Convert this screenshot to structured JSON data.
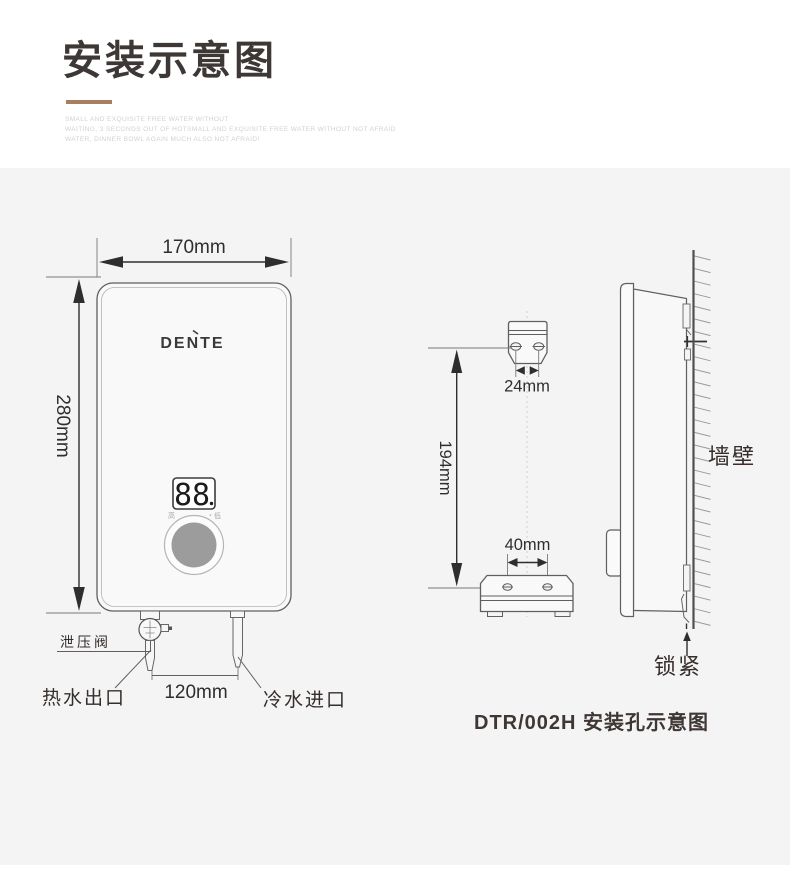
{
  "header": {
    "title": "安装示意图",
    "accent_color": "#a87e60",
    "subtitle_lines": [
      "SMALL AND EXQUISITE FREE WATER WITHOUT",
      "WAITING, 3 SECONDS OUT OF HOTSMALL AND EXQUISITE FREE WATER WITHOUT NOT AFRAID",
      "WATER, DINNER BOWL AGAIN MUCH ALSO NOT AFRAID!"
    ]
  },
  "front_view": {
    "brand": "DENTE",
    "display_value": "88",
    "knob_label_high": "高",
    "knob_label_low": "低",
    "dims": {
      "width": "170mm",
      "height": "280mm",
      "pipe_spacing": "120mm"
    },
    "labels": {
      "relief_valve": "泄压阀",
      "hot_water_outlet": "热水出口",
      "cold_water_inlet": "冷水进口"
    }
  },
  "side_view": {
    "dims": {
      "top_hole_spacing": "24mm",
      "hole_vertical_distance": "194mm",
      "bottom_hole_spacing": "40mm"
    },
    "labels": {
      "wall": "墙壁",
      "lock": "锁紧"
    },
    "caption": "DTR/002H 安装孔示意图"
  }
}
